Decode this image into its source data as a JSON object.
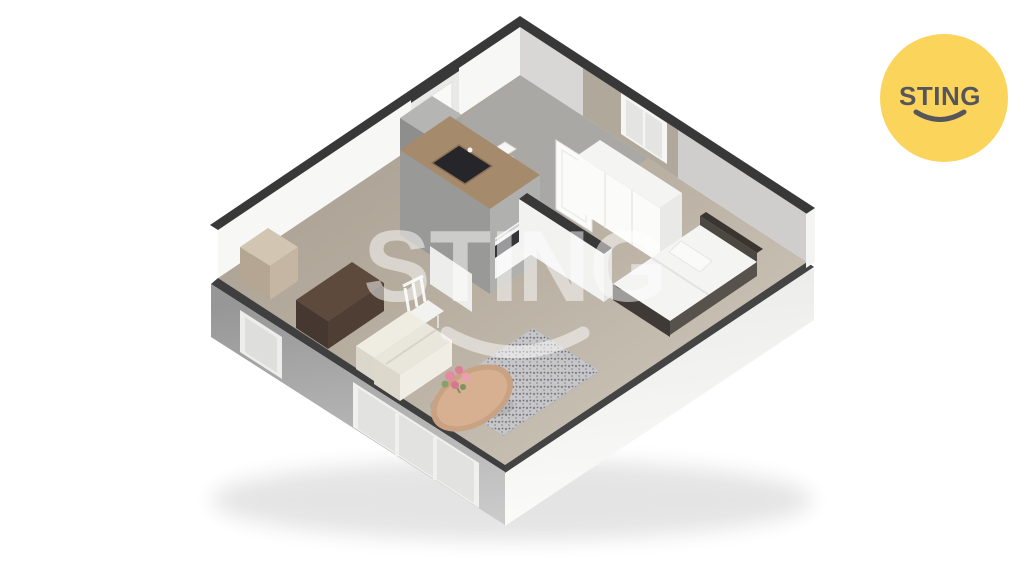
{
  "image": {
    "type": "3d-floorplan-render",
    "description": "Isometric 3D floor plan render of a small one-room apartment",
    "rooms": [
      "living-room",
      "kitchen",
      "bathroom",
      "hall",
      "bedroom-nook"
    ]
  },
  "watermark": {
    "text": "STING",
    "opacity": "0.5"
  },
  "logo": {
    "text": "STING"
  },
  "colors": {
    "background": "#FFFFFF",
    "floor_dark": "#A89E92",
    "floor": "#B6AD9F",
    "floor_light": "#C8C0B3",
    "bathroom_floor": "#A9A8A4",
    "wall_top": "#383838",
    "wall_interior_light": "#F7F7F6",
    "wall_interior_shaded": "#D8D7D5",
    "wall_taupe": "#B1A89C",
    "exterior_left_top": "#979797",
    "exterior_left_bottom": "#CACACA",
    "exterior_right_top": "#EDEDEC",
    "exterior_right_bottom": "#FCFCFB",
    "kitchen_counter": "#A58A6B",
    "kitchen_body": "#999997",
    "cooktop": "#26262A",
    "bed_frame": "#3F3A36",
    "sofa": "#E9E6DC",
    "desk": "#5D4A3C",
    "rug_base": "#C7C7C9",
    "table": "#C9A183",
    "flowers": "#E38BA0",
    "watermark_white": "#FFFFFF",
    "logo_yellow": "#FBD45C",
    "logo_text": "#55565B"
  }
}
